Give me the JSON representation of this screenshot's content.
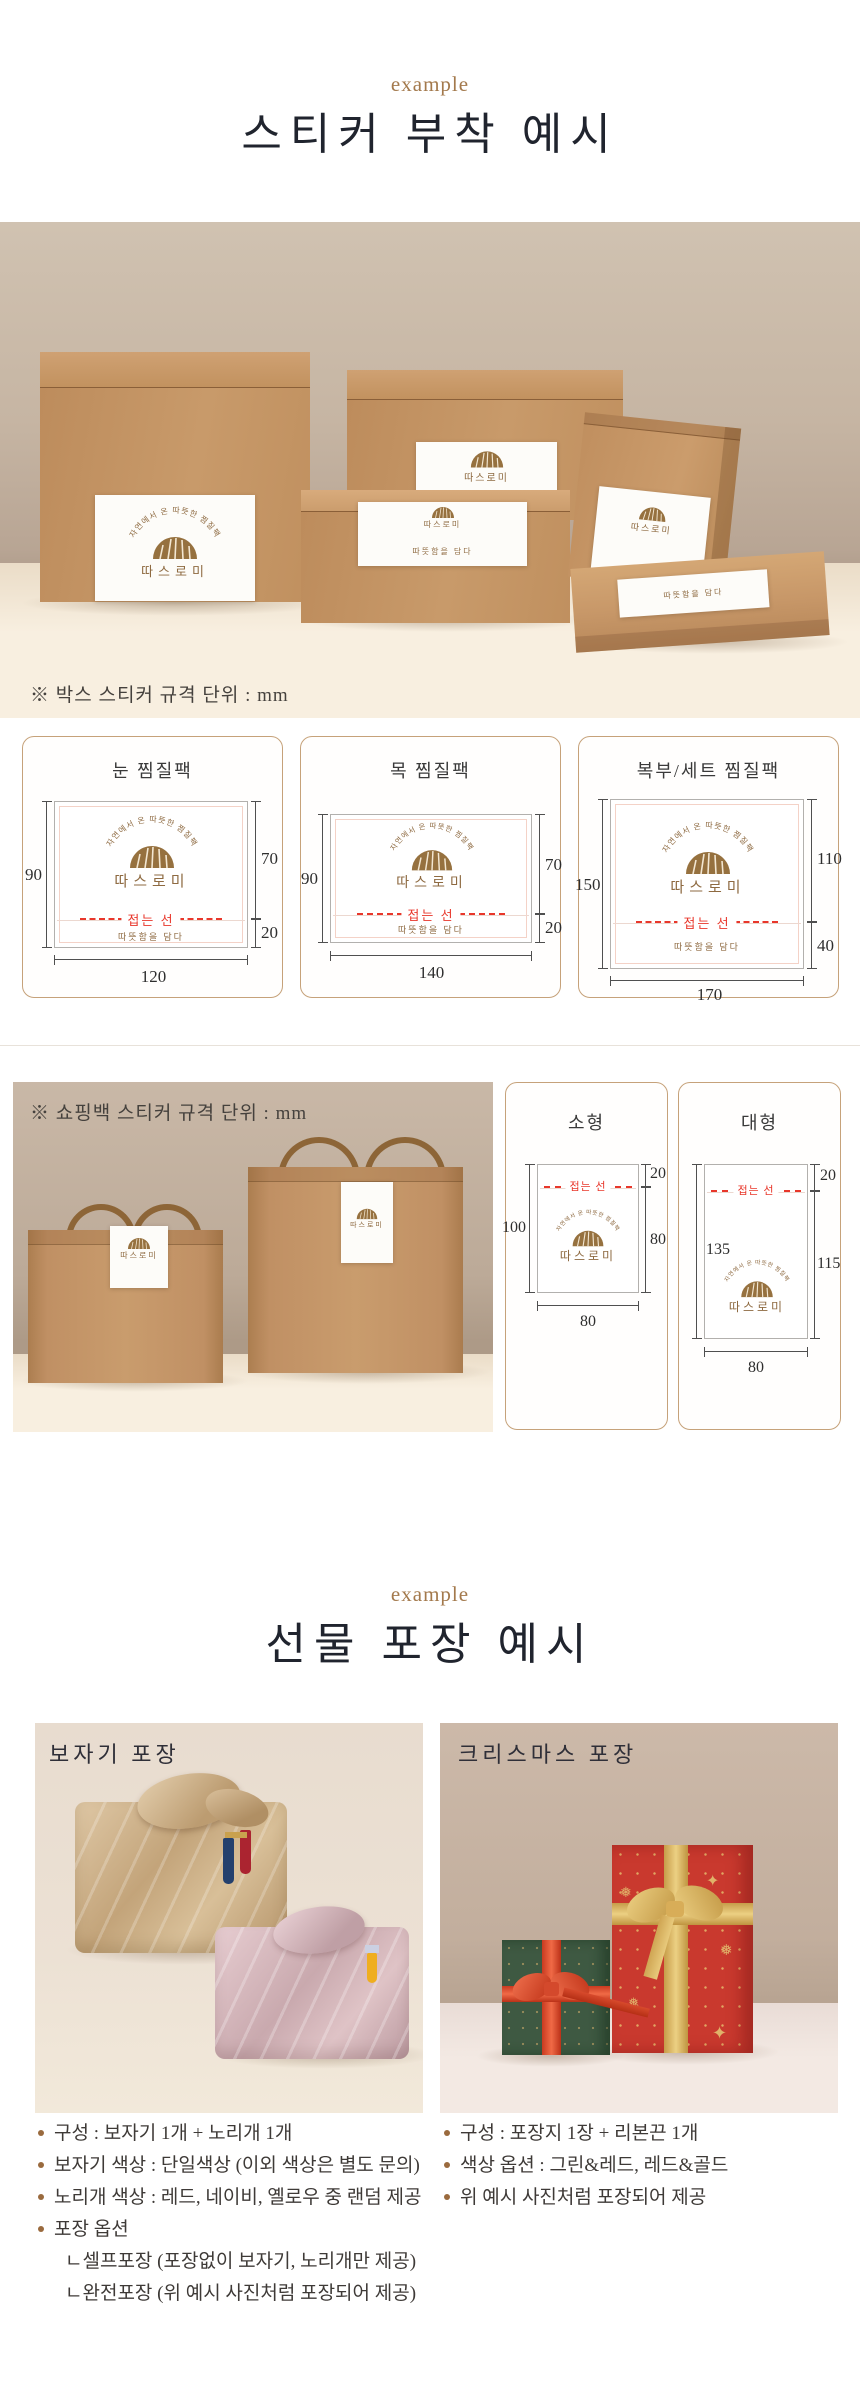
{
  "brand": {
    "arc_text": "자연에서 온 따뜻한 찜질팩",
    "name": "따스로미",
    "tagline": "따뜻함을 담다"
  },
  "colors": {
    "accent_brown": "#9a6a3e",
    "logo_brown": "#96713f",
    "fold_red": "#e8372b",
    "kraft": "#c49365",
    "card_border": "#c6a27a",
    "title_dark": "#20242e"
  },
  "section_sticker": {
    "eyebrow": "example",
    "title": "스티커 부착 예시",
    "photo_note": "※ 박스 스티커 규격 단위 : mm",
    "fold_label": "접는 선",
    "box_cards": [
      {
        "title": "눈 찜질팩",
        "dim_left": "90",
        "dim_right_top": "70",
        "dim_right_bottom": "20",
        "dim_bottom": "120"
      },
      {
        "title": "목 찜질팩",
        "dim_left": "90",
        "dim_right_top": "70",
        "dim_right_bottom": "20",
        "dim_bottom": "140"
      },
      {
        "title": "복부/세트 찜질팩",
        "dim_left": "150",
        "dim_right_top": "110",
        "dim_right_bottom": "40",
        "dim_bottom": "170"
      }
    ]
  },
  "section_bag": {
    "photo_note": "※ 쇼핑백 스티커 규격 단위 : mm",
    "fold_label": "접는 선",
    "bag_cards": [
      {
        "title": "소형",
        "dim_left": "100",
        "dim_right_top": "20",
        "dim_right_bottom": "80",
        "dim_bottom": "80"
      },
      {
        "title": "대형",
        "dim_left": "135",
        "dim_right_top": "20",
        "dim_right_bottom": "115",
        "dim_bottom": "80"
      }
    ]
  },
  "section_gift": {
    "eyebrow": "example",
    "title": "선물 포장 예시",
    "left": {
      "title": "보자기 포장",
      "bullets": [
        "구성 : 보자기 1개 + 노리개 1개",
        "보자기 색상 : 단일색상 (이외 색상은 별도 문의)",
        "노리개 색상 : 레드, 네이비, 옐로우 중 랜덤 제공",
        "포장 옵션"
      ],
      "sub_bullets": [
        "ㄴ셀프포장 (포장없이 보자기, 노리개만 제공)",
        "ㄴ완전포장 (위 예시 사진처럼 포장되어 제공)"
      ]
    },
    "right": {
      "title": "크리스마스 포장",
      "bullets": [
        "구성 : 포장지 1장 + 리본끈 1개",
        "색상 옵션 : 그린&레드, 레드&골드",
        "위 예시 사진처럼 포장되어 제공"
      ]
    }
  }
}
